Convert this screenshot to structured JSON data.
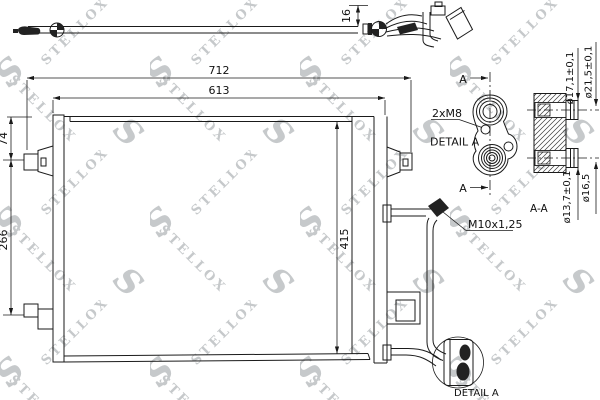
{
  "page": {
    "background": "#ffffff",
    "ink": "#1a1a1a"
  },
  "watermark": {
    "brand": "STELLOX",
    "logo_letter": "S",
    "color": "#c6c9cb"
  },
  "dimensions": {
    "overall_width": "712",
    "core_width": "613",
    "left_bracket_offset": "74",
    "bracket_spacing": "266",
    "core_height": "415",
    "pipe_offset": "16"
  },
  "callouts": {
    "bolt_holes": "2xM8",
    "detail_label": "DETAIL A",
    "detail_balloon_label": "DETAIL A",
    "pipe_thread": "M10x1,25",
    "section_label": "A-A",
    "cut_marker_top": "A",
    "cut_marker_bottom": "A"
  },
  "port_dimensions": {
    "upper_inner": "ø17,1±0,1",
    "upper_outer": "ø21,5±0,1",
    "lower_inner": "ø13,7±0,1",
    "lower_outer": "ø16,5"
  }
}
